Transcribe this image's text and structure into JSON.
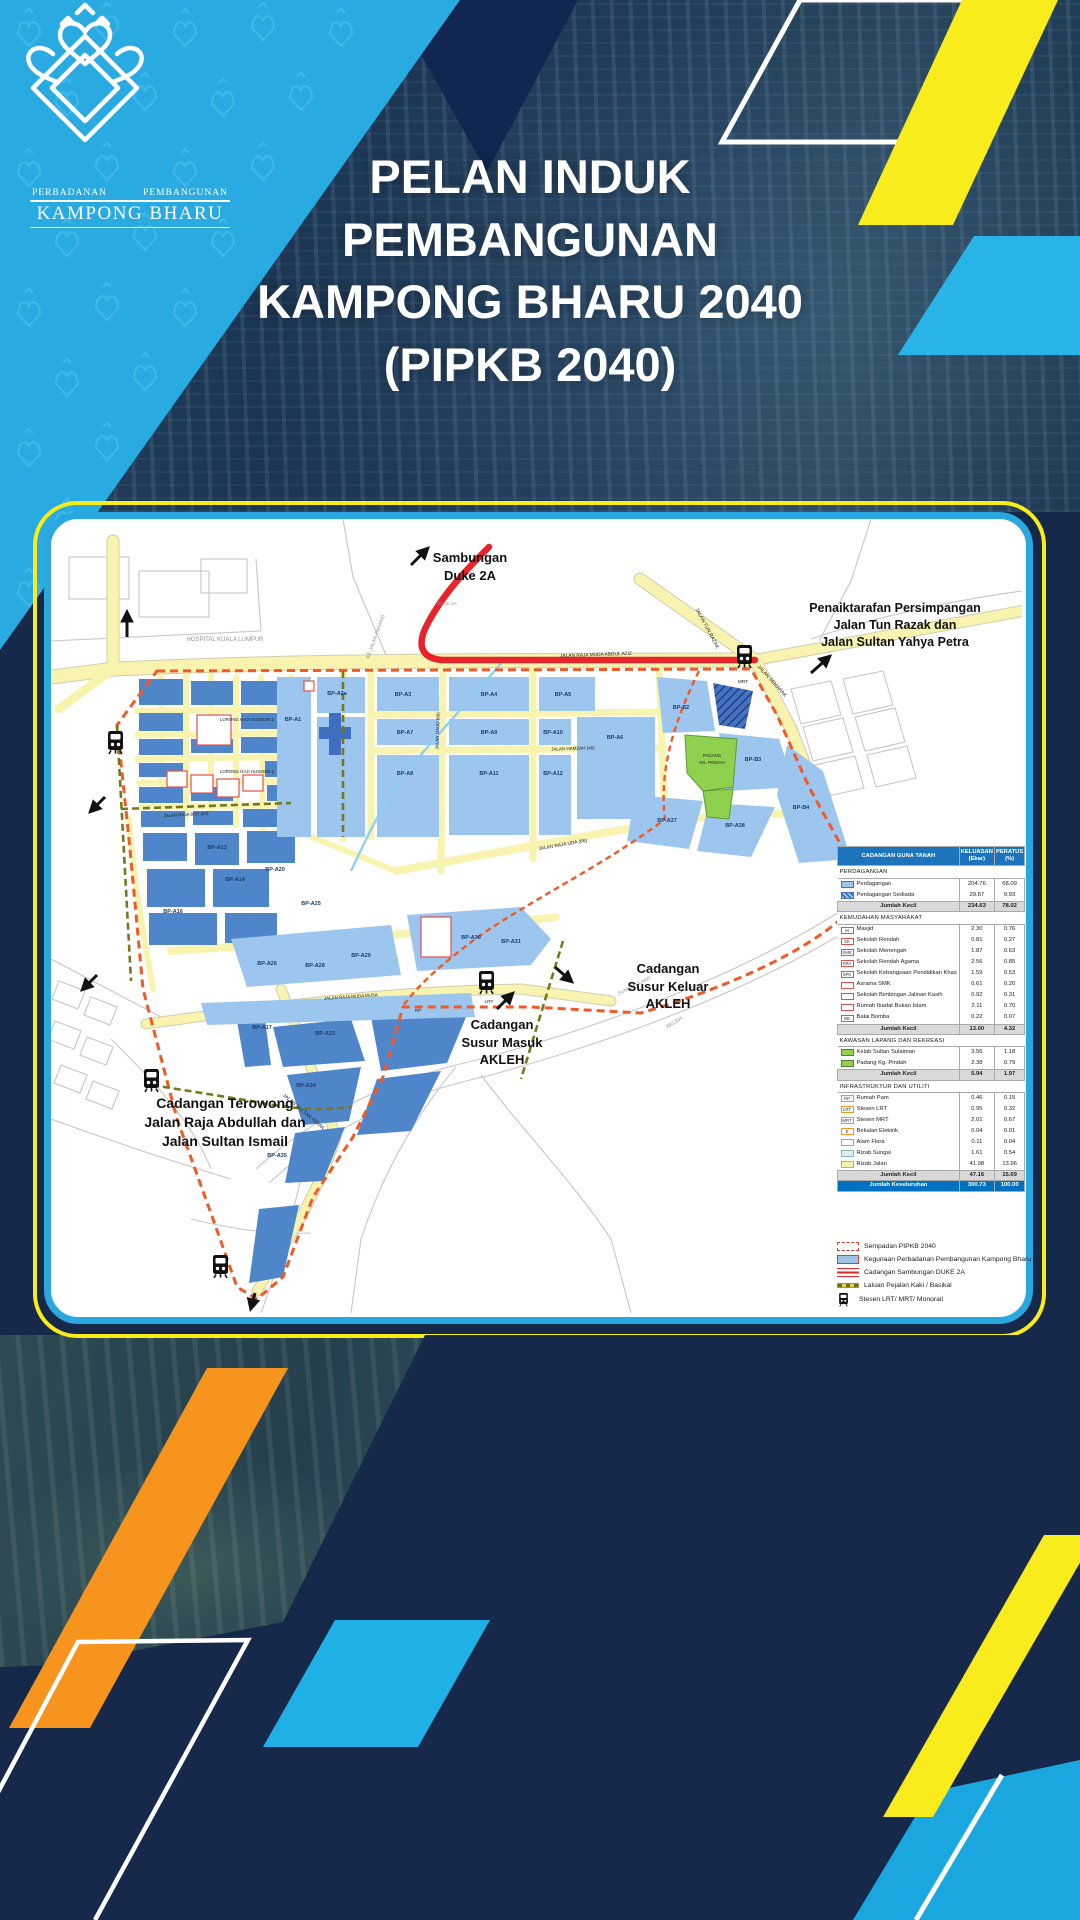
{
  "logo": {
    "org_line1": "PERBADANAN",
    "org_line2": "PEMBANGUNAN",
    "org_name": "KAMPONG BHARU"
  },
  "title": {
    "text": "PELAN INDUK\nPEMBANGUNAN\nKAMPONG BHARU 2040\n(PIPKB 2040)"
  },
  "colors": {
    "brand_cyan": "#29abe2",
    "brand_yellow": "#f8ec1c",
    "brand_orange": "#f7941e",
    "navy": "#17294b",
    "card_border_blue": "#29a8e0",
    "duke_red": "#e8242a",
    "boundary_red": "#f05a28",
    "parcel_blue_light": "#9dc6ef",
    "parcel_blue_mid": "#4f86c9",
    "road_yellow": "#f9f3b0",
    "green": "#8fd14f",
    "table_header_blue": "#1c75bc",
    "total_row_blue": "#0070c0"
  },
  "map": {
    "annotations": {
      "duke2a": "Sambungan\nDuke 2A",
      "penaiktarafan": "Penaiktarafan Persimpangan\nJalan Tun Razak dan\nJalan Sultan Yahya Petra",
      "susur_keluar": "Cadangan\nSusur Keluar\nAKLEH",
      "susur_masuk": "Cadangan\nSusur Masuk\nAKLEH",
      "terowong": "Cadangan Terowong\nJalan Raja Abdullah dan\nJalan Sultan Ismail"
    },
    "labels": [
      {
        "t": "HOSPITAL KUALA LUMPUR",
        "x": 174,
        "y": 122,
        "s": 6,
        "c": "g"
      },
      {
        "t": "KE JALAN PAHANG",
        "x": 326,
        "y": 118,
        "r": -70,
        "s": 5,
        "c": "g"
      },
      {
        "t": "DUKE 2A",
        "x": 396,
        "y": 86,
        "s": 4.5,
        "c": "g"
      },
      {
        "t": "SUNGAI KLANG",
        "x": 584,
        "y": 468,
        "r": -27,
        "s": 4.8,
        "c": "g"
      },
      {
        "t": "AKLEH",
        "x": 624,
        "y": 505,
        "r": -30,
        "s": 5.5,
        "c": "g"
      },
      {
        "t": "JALAN RAJA MUDA ABDUL AZIZ",
        "x": 545,
        "y": 137,
        "r": -2,
        "s": 4.8
      },
      {
        "t": "LORONG HAJI HUSSEIN 2",
        "x": 196,
        "y": 202,
        "s": 4.4
      },
      {
        "t": "LORONG HAJI HUSSEIN 1",
        "x": 196,
        "y": 254,
        "s": 4.4
      },
      {
        "t": "JALAN RAJA BOT (60)",
        "x": 135,
        "y": 297,
        "r": -3,
        "s": 4.4
      },
      {
        "t": "JALAN DAUD (66)",
        "x": 388,
        "y": 212,
        "r": -88,
        "s": 4.5
      },
      {
        "t": "JALAN HAMZAH (46)",
        "x": 522,
        "y": 231,
        "r": -2,
        "s": 4.5
      },
      {
        "t": "JALAN RAJA UDA (66)",
        "x": 512,
        "y": 327,
        "r": -10,
        "s": 4.8
      },
      {
        "t": "JALAN TUN RAZAK",
        "x": 655,
        "y": 110,
        "r": 62,
        "s": 5
      },
      {
        "t": "JALAN SEMARAK",
        "x": 720,
        "y": 163,
        "r": 48,
        "s": 5
      },
      {
        "t": "JALAN SULTAN ISMAIL",
        "x": 252,
        "y": 594,
        "r": 40,
        "s": 5
      },
      {
        "t": "JALAN RAJA MUDA MUSA",
        "x": 300,
        "y": 479,
        "r": -4,
        "s": 4.4
      },
      {
        "t": "PADANG",
        "x": 661,
        "y": 238,
        "s": 4.4
      },
      {
        "t": "KG. PINDAH",
        "x": 661,
        "y": 245,
        "s": 4.4
      },
      {
        "t": "MRT",
        "x": 692,
        "y": 164,
        "s": 4.8
      },
      {
        "t": "LRT",
        "x": 438,
        "y": 484,
        "s": 4.8
      },
      {
        "t": "RP",
        "x": 367,
        "y": 493,
        "s": 4.5
      },
      {
        "t": "BP-A1",
        "x": 242,
        "y": 202,
        "s": 5.5,
        "c": "bp"
      },
      {
        "t": "BP-A2a",
        "x": 286,
        "y": 176,
        "s": 5.5,
        "c": "bp"
      },
      {
        "t": "BP-A3",
        "x": 352,
        "y": 177,
        "s": 5.5,
        "c": "bp"
      },
      {
        "t": "BP-A4",
        "x": 438,
        "y": 177,
        "s": 5.5,
        "c": "bp"
      },
      {
        "t": "BP-A5",
        "x": 512,
        "y": 177,
        "s": 5.5,
        "c": "bp"
      },
      {
        "t": "BP-A6",
        "x": 564,
        "y": 220,
        "s": 5.5,
        "c": "bp"
      },
      {
        "t": "BP-A7",
        "x": 354,
        "y": 215,
        "s": 5.5,
        "c": "bp"
      },
      {
        "t": "BP-A8",
        "x": 354,
        "y": 256,
        "s": 5.5,
        "c": "bp"
      },
      {
        "t": "BP-A9",
        "x": 438,
        "y": 215,
        "s": 5.5,
        "c": "bp"
      },
      {
        "t": "BP-A10",
        "x": 502,
        "y": 215,
        "s": 5.5,
        "c": "bp"
      },
      {
        "t": "BP-A11",
        "x": 438,
        "y": 256,
        "s": 5.5,
        "c": "bp"
      },
      {
        "t": "BP-A12",
        "x": 502,
        "y": 256,
        "s": 5.5,
        "c": "bp"
      },
      {
        "t": "BP-B2",
        "x": 630,
        "y": 190,
        "s": 5.5,
        "c": "bp"
      },
      {
        "t": "BP-B3",
        "x": 702,
        "y": 242,
        "s": 5.5,
        "c": "bp"
      },
      {
        "t": "BP-B4",
        "x": 750,
        "y": 290,
        "s": 5.5,
        "c": "bp"
      },
      {
        "t": "BP-A37",
        "x": 616,
        "y": 303,
        "s": 5.5,
        "c": "bp"
      },
      {
        "t": "BP-A38",
        "x": 684,
        "y": 308,
        "s": 5.5,
        "c": "bp"
      },
      {
        "t": "BP-A30",
        "x": 420,
        "y": 420,
        "s": 5.5,
        "c": "bp"
      },
      {
        "t": "BP-A31",
        "x": 460,
        "y": 424,
        "s": 5.5,
        "c": "bp"
      },
      {
        "t": "BP-A17",
        "x": 211,
        "y": 510,
        "s": 5.5,
        "c": "bp"
      },
      {
        "t": "BP-A33",
        "x": 274,
        "y": 516,
        "s": 5.5,
        "c": "bp"
      },
      {
        "t": "BP-A34",
        "x": 255,
        "y": 568,
        "s": 5.5,
        "c": "bp"
      },
      {
        "t": "BP-A35",
        "x": 226,
        "y": 638,
        "s": 5.5,
        "c": "bp"
      },
      {
        "t": "BP-A13",
        "x": 166,
        "y": 330,
        "s": 5.5,
        "c": "bp"
      },
      {
        "t": "BP-A14",
        "x": 184,
        "y": 362,
        "s": 5.5,
        "c": "bp"
      },
      {
        "t": "BP-A16",
        "x": 122,
        "y": 394,
        "s": 5.5,
        "c": "bp"
      },
      {
        "t": "BP-A20",
        "x": 224,
        "y": 352,
        "s": 5.5,
        "c": "bp"
      },
      {
        "t": "BP-A25",
        "x": 260,
        "y": 386,
        "s": 5.5,
        "c": "bp"
      },
      {
        "t": "BP-A26",
        "x": 216,
        "y": 446,
        "s": 5.5,
        "c": "bp"
      },
      {
        "t": "BP-A28",
        "x": 264,
        "y": 448,
        "s": 5.5,
        "c": "bp"
      },
      {
        "t": "BP-A29",
        "x": 310,
        "y": 438,
        "s": 5.5,
        "c": "bp"
      }
    ]
  },
  "legend_table": {
    "headers": [
      "CADANGAN GUNA TANAH",
      "KELUASAN\n(Ekar)",
      "PERATUS\n(%)"
    ],
    "subtotal_label": "Jumlah Kecil",
    "sections": [
      {
        "title": "PERDAGANGAN",
        "rows": [
          {
            "sw": "blue",
            "label": "Perdagangan",
            "k": "204.76",
            "p": "68.09"
          },
          {
            "sw": "hatch",
            "label": "Perdagangan Sediada",
            "k": "29.87",
            "p": "9.93"
          }
        ],
        "subtotal": [
          "234.63",
          "78.02"
        ]
      },
      {
        "title": "KEMUDAHAN MASYARAKAT",
        "rows": [
          {
            "sw": "rb",
            "code": "M",
            "label": "Masjid",
            "k": "2.30",
            "p": "0.76"
          },
          {
            "sw": "rb",
            "code": "SK",
            "label": "Sekolah Rendah",
            "k": "0.81",
            "p": "0.27"
          },
          {
            "sw": "rb",
            "code": "SMK",
            "label": "Sekolah Menengah",
            "k": "1.87",
            "p": "0.63"
          },
          {
            "sw": "rb",
            "code": "SRA",
            "label": "Sekolah Rendah Agama",
            "k": "2.56",
            "p": "0.85"
          },
          {
            "sw": "rb",
            "code": "SPK",
            "label": "Sekolah Kebangsaan Pendidikan Khas",
            "k": "1.59",
            "p": "0.53"
          },
          {
            "sw": "rb",
            "code": "",
            "label": "Asrama SMK",
            "k": "0.61",
            "p": "0.20"
          },
          {
            "sw": "rb",
            "code": "",
            "label": "Sekolah Bimbingan Jalinan Kasih",
            "k": "0.92",
            "p": "0.31"
          },
          {
            "sw": "rb",
            "code": "",
            "label": "Rumah Ibadat Bukan Islam",
            "k": "2.11",
            "p": "0.70"
          },
          {
            "sw": "rb",
            "code": "BB",
            "label": "Balai Bomba",
            "k": "0.22",
            "p": "0.07"
          }
        ],
        "subtotal": [
          "13.00",
          "4.32"
        ]
      },
      {
        "title": "KAWASAN LAPANG DAN REKREASI",
        "rows": [
          {
            "sw": "green",
            "label": "Kelab Sultan Sulaiman",
            "k": "3.56",
            "p": "1.18"
          },
          {
            "sw": "green",
            "label": "Padang Kg. Pindah",
            "k": "2.38",
            "p": "0.79"
          }
        ],
        "subtotal": [
          "5.94",
          "1.97"
        ]
      },
      {
        "title": "INFRASTRUKTUR DAN UTILITI",
        "rows": [
          {
            "sw": "ob",
            "code": "RP",
            "label": "Rumah Pam",
            "k": "0.46",
            "p": "0.15"
          },
          {
            "sw": "ob",
            "code": "LRT",
            "label": "Stesen LRT",
            "k": "0.95",
            "p": "0.32"
          },
          {
            "sw": "ob",
            "code": "MRT",
            "label": "Stesen MRT",
            "k": "2.01",
            "p": "0.67"
          },
          {
            "sw": "ob",
            "code": "E",
            "label": "Bekalan Elektrik",
            "k": "0.04",
            "p": "0.01"
          },
          {
            "sw": "ob",
            "code": "",
            "label": "Alam Flora",
            "k": "0.11",
            "p": "0.04"
          },
          {
            "sw": "cyan",
            "label": "Rizab Sungai",
            "k": "1.61",
            "p": "0.54"
          },
          {
            "sw": "yellow",
            "label": "Rizab Jalan",
            "k": "41.98",
            "p": "13.96"
          }
        ],
        "subtotal": [
          "47.16",
          "15.69"
        ]
      }
    ],
    "total": {
      "label": "Jumlah Keseluruhan",
      "keluasan": "300.73",
      "peratus": "100.00"
    }
  },
  "symbol_legend": [
    {
      "sym": "boundary",
      "label": "Sempadan PIPKB 2040"
    },
    {
      "sym": "pkb",
      "label": "Kegunaan Perbadanan Pembangunan Kampong Bharu"
    },
    {
      "sym": "duke",
      "label": "Cadangan Sambungan DUKE 2A"
    },
    {
      "sym": "pejalan",
      "label": "Laluan Pejalan Kaki / Basikal"
    },
    {
      "sym": "train",
      "label": "Stesen LRT/ MRT/ Monorail"
    }
  ]
}
